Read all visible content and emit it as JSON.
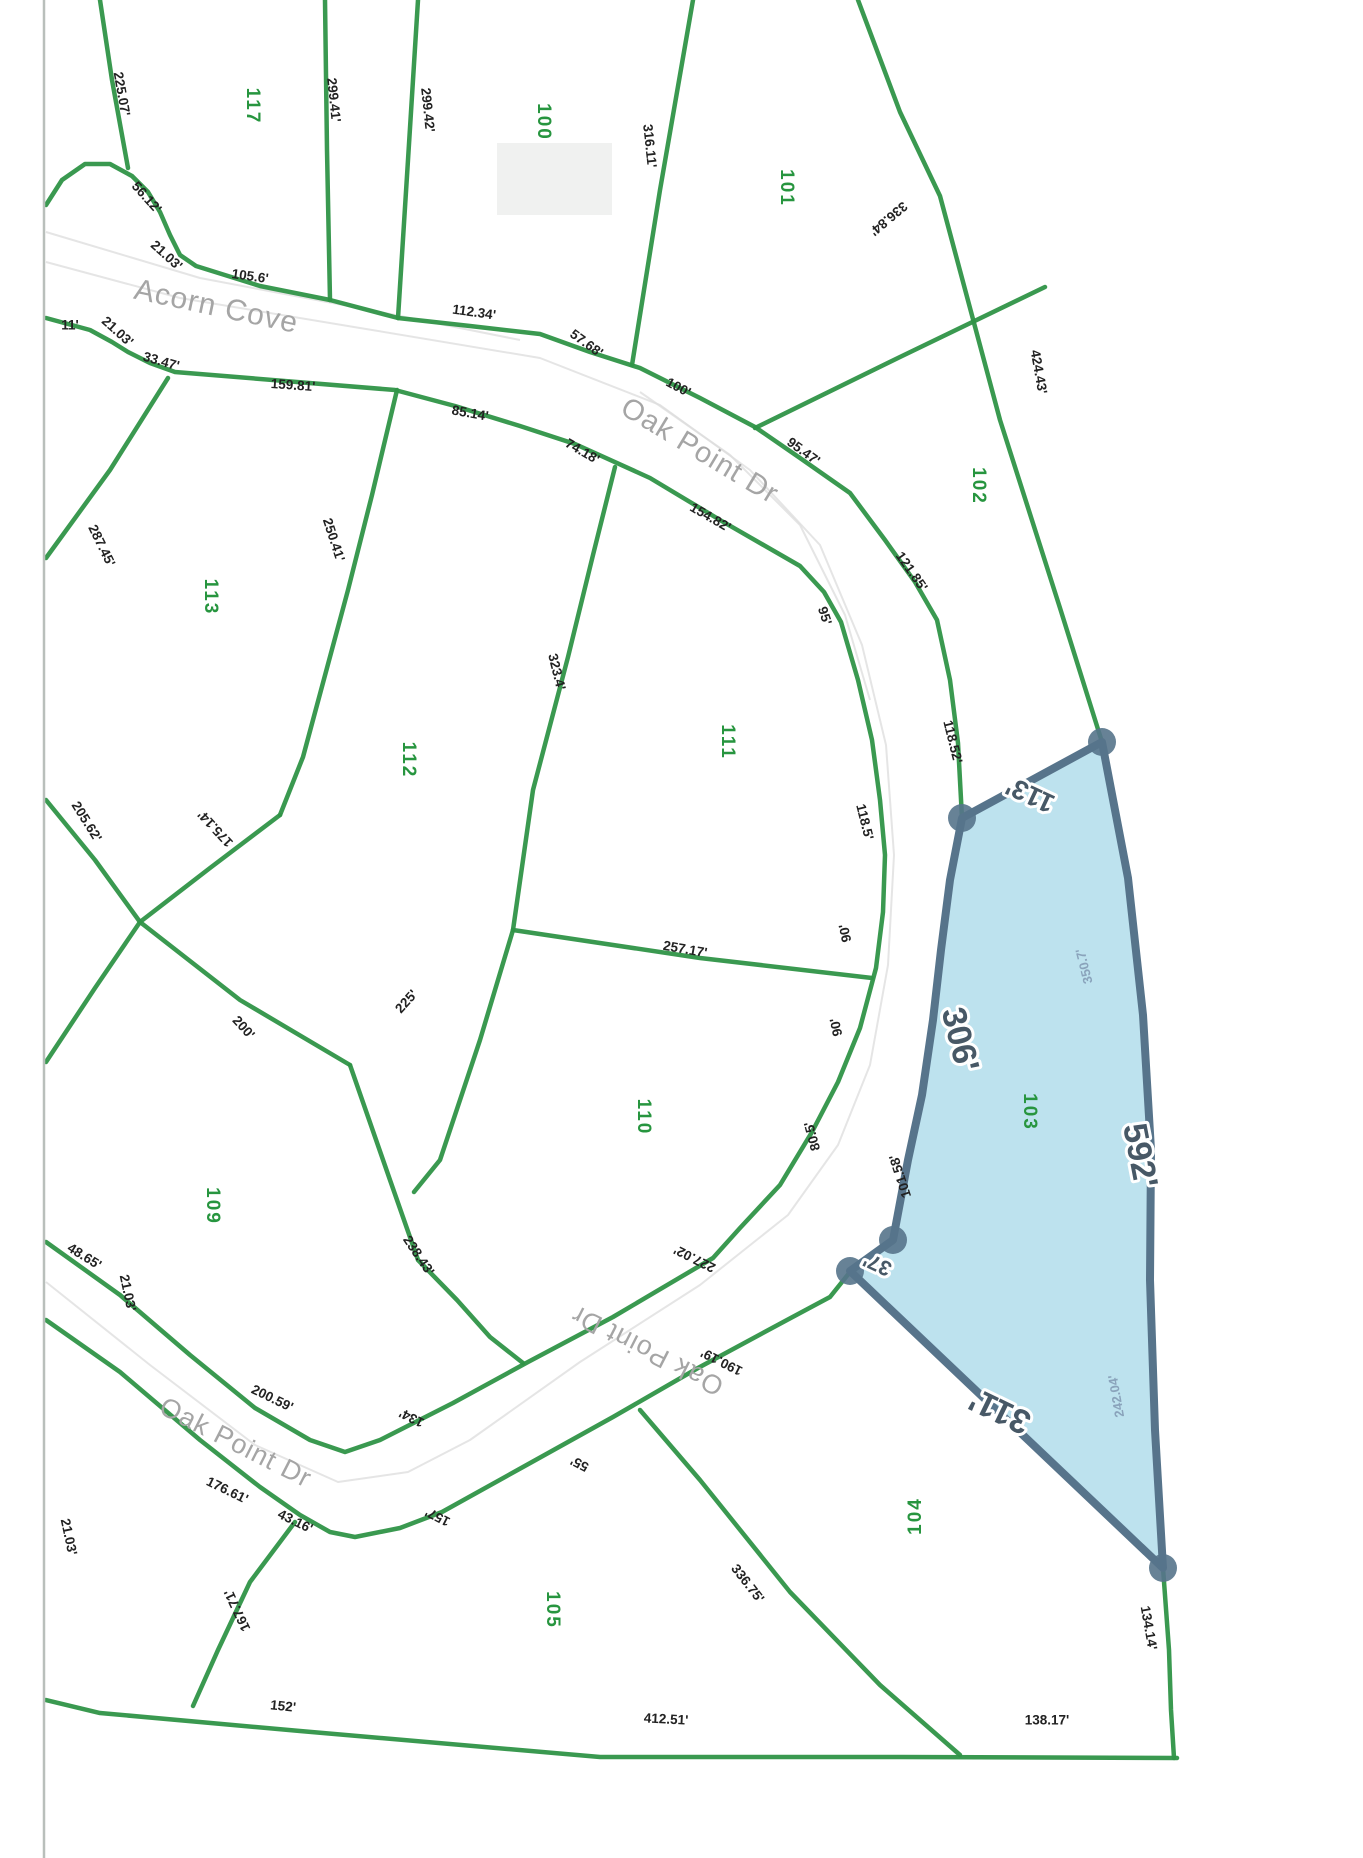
{
  "page": {
    "width": 1363,
    "height": 1858,
    "background": "#ffffff"
  },
  "colors": {
    "parcel_line": "#2f9447",
    "lot_number": "#27953f",
    "dimension_text": "#222222",
    "street_text": "#a5a5a5",
    "highlight_fill": "#b7e0ed",
    "highlight_stroke": "#57748b",
    "highlight_label": "#475866",
    "highlight_sub_label": "#8aa3bb",
    "page_edge": "#b9bfbb",
    "road_artifact": "#dcdcdc"
  },
  "streets": [
    {
      "name": "Acorn Cove",
      "x": 216,
      "y": 308,
      "rot": 12,
      "size": 30
    },
    {
      "name": "Oak Point Dr",
      "x": 699,
      "y": 452,
      "rot": 31,
      "size": 29
    },
    {
      "name": "Oak Point Dr",
      "x": 235,
      "y": 1444,
      "rot": 27,
      "size": 27
    },
    {
      "name": "Oak Point Dr",
      "x": 648,
      "y": 1349,
      "rot": 207,
      "size": 27
    }
  ],
  "lots": [
    {
      "number": "117",
      "x": 252,
      "y": 106,
      "rot": 90
    },
    {
      "number": "100",
      "x": 543,
      "y": 122,
      "rot": 90
    },
    {
      "number": "101",
      "x": 786,
      "y": 188,
      "rot": 90
    },
    {
      "number": "102",
      "x": 978,
      "y": 486,
      "rot": 90
    },
    {
      "number": "113",
      "x": 210,
      "y": 597,
      "rot": 90
    },
    {
      "number": "112",
      "x": 408,
      "y": 760,
      "rot": 90
    },
    {
      "number": "111",
      "x": 727,
      "y": 742,
      "rot": 90
    },
    {
      "number": "110",
      "x": 643,
      "y": 1117,
      "rot": 90
    },
    {
      "number": "109",
      "x": 212,
      "y": 1206,
      "rot": 90
    },
    {
      "number": "103",
      "x": 1029,
      "y": 1112,
      "rot": 90
    },
    {
      "number": "105",
      "x": 552,
      "y": 1610,
      "rot": 90
    },
    {
      "number": "104",
      "x": 916,
      "y": 1516,
      "rot": -90
    }
  ],
  "dimensions": [
    {
      "text": "225.07'",
      "x": 121,
      "y": 94,
      "rot": 80
    },
    {
      "text": "299.41'",
      "x": 333,
      "y": 100,
      "rot": 84
    },
    {
      "text": "299.42'",
      "x": 427,
      "y": 110,
      "rot": 84
    },
    {
      "text": "316.11'",
      "x": 649,
      "y": 146,
      "rot": 84
    },
    {
      "text": "336.84'",
      "x": 888,
      "y": 218,
      "rot": 140
    },
    {
      "text": "424.43'",
      "x": 1038,
      "y": 372,
      "rot": 80
    },
    {
      "text": "56.12'",
      "x": 146,
      "y": 198,
      "rot": 48
    },
    {
      "text": "21.03'",
      "x": 166,
      "y": 256,
      "rot": 42
    },
    {
      "text": "105.6'",
      "x": 250,
      "y": 277,
      "rot": 8
    },
    {
      "text": "11'",
      "x": 70,
      "y": 326,
      "rot": 0
    },
    {
      "text": "21.03'",
      "x": 117,
      "y": 332,
      "rot": 42
    },
    {
      "text": "33.47'",
      "x": 161,
      "y": 362,
      "rot": 16
    },
    {
      "text": "159.81'",
      "x": 293,
      "y": 386,
      "rot": 4
    },
    {
      "text": "112.34'",
      "x": 474,
      "y": 313,
      "rot": 8
    },
    {
      "text": "57.68'",
      "x": 586,
      "y": 344,
      "rot": 36
    },
    {
      "text": "100'",
      "x": 678,
      "y": 388,
      "rot": 28
    },
    {
      "text": "85.14'",
      "x": 470,
      "y": 414,
      "rot": 10
    },
    {
      "text": "74.18'",
      "x": 582,
      "y": 452,
      "rot": 30
    },
    {
      "text": "95.47'",
      "x": 803,
      "y": 452,
      "rot": 36
    },
    {
      "text": "154.82'",
      "x": 710,
      "y": 518,
      "rot": 30
    },
    {
      "text": "121.85'",
      "x": 911,
      "y": 572,
      "rot": 55
    },
    {
      "text": "95'",
      "x": 824,
      "y": 616,
      "rot": 72
    },
    {
      "text": "287.45'",
      "x": 101,
      "y": 546,
      "rot": 64
    },
    {
      "text": "250.41'",
      "x": 333,
      "y": 540,
      "rot": 72
    },
    {
      "text": "323.4'",
      "x": 556,
      "y": 672,
      "rot": 76
    },
    {
      "text": "205.62'",
      "x": 86,
      "y": 822,
      "rot": 58
    },
    {
      "text": "175.14'",
      "x": 216,
      "y": 828,
      "rot": 227
    },
    {
      "text": "200'",
      "x": 243,
      "y": 1028,
      "rot": 48
    },
    {
      "text": "225'",
      "x": 407,
      "y": 1002,
      "rot": -48
    },
    {
      "text": "257.17'",
      "x": 685,
      "y": 950,
      "rot": 10
    },
    {
      "text": "118.52'",
      "x": 952,
      "y": 742,
      "rot": 76
    },
    {
      "text": "118.5'",
      "x": 864,
      "y": 822,
      "rot": 76
    },
    {
      "text": "90'",
      "x": 846,
      "y": 933,
      "rot": -102
    },
    {
      "text": "90'",
      "x": 837,
      "y": 1027,
      "rot": -102
    },
    {
      "text": "80.5'",
      "x": 813,
      "y": 1136,
      "rot": -105
    },
    {
      "text": "101.58'",
      "x": 901,
      "y": 1176,
      "rot": -108
    },
    {
      "text": "48.65'",
      "x": 84,
      "y": 1257,
      "rot": 32
    },
    {
      "text": "21.03'",
      "x": 127,
      "y": 1293,
      "rot": 78
    },
    {
      "text": "238.43'",
      "x": 418,
      "y": 1256,
      "rot": 56
    },
    {
      "text": "227.02'",
      "x": 695,
      "y": 1258,
      "rot": 207
    },
    {
      "text": "190.19'",
      "x": 722,
      "y": 1361,
      "rot": 207
    },
    {
      "text": "200.59'",
      "x": 272,
      "y": 1399,
      "rot": 26
    },
    {
      "text": "134'",
      "x": 412,
      "y": 1417,
      "rot": 207
    },
    {
      "text": "176.61'",
      "x": 227,
      "y": 1491,
      "rot": 26
    },
    {
      "text": "43.16'",
      "x": 295,
      "y": 1522,
      "rot": 26
    },
    {
      "text": "157'",
      "x": 438,
      "y": 1516,
      "rot": 207
    },
    {
      "text": "55'",
      "x": 580,
      "y": 1463,
      "rot": 207
    },
    {
      "text": "21.03'",
      "x": 68,
      "y": 1537,
      "rot": 78
    },
    {
      "text": "167.71'",
      "x": 238,
      "y": 1610,
      "rot": 245
    },
    {
      "text": "152'",
      "x": 283,
      "y": 1707,
      "rot": 6
    },
    {
      "text": "336.75'",
      "x": 747,
      "y": 1584,
      "rot": 52
    },
    {
      "text": "412.51'",
      "x": 666,
      "y": 1720,
      "rot": 3
    },
    {
      "text": "138.17'",
      "x": 1047,
      "y": 1721,
      "rot": 0
    },
    {
      "text": "134.14'",
      "x": 1148,
      "y": 1628,
      "rot": 80
    }
  ],
  "highlight": {
    "lot": "103",
    "polygon": [
      [
        1102,
        742
      ],
      [
        962,
        818
      ],
      [
        950,
        880
      ],
      [
        941,
        950
      ],
      [
        933,
        1020
      ],
      [
        922,
        1095
      ],
      [
        908,
        1160
      ],
      [
        893,
        1240
      ],
      [
        850,
        1271
      ],
      [
        1163,
        1568
      ],
      [
        1155,
        1430
      ],
      [
        1150,
        1280
      ],
      [
        1151,
        1150
      ],
      [
        1143,
        1015
      ],
      [
        1128,
        878
      ]
    ],
    "vertices": [
      [
        1102,
        742
      ],
      [
        962,
        818
      ],
      [
        893,
        1240
      ],
      [
        850,
        1271
      ],
      [
        1163,
        1568
      ]
    ],
    "labels": [
      {
        "text": "113'",
        "x": 1031,
        "y": 793,
        "rot": 205,
        "size": 27
      },
      {
        "text": "306'",
        "x": 958,
        "y": 1040,
        "rot": 76,
        "size": 34
      },
      {
        "text": "592'",
        "x": 1138,
        "y": 1156,
        "rot": 79,
        "size": 34
      },
      {
        "text": "311'",
        "x": 1001,
        "y": 1409,
        "rot": 206,
        "size": 34
      },
      {
        "text": "37'",
        "x": 878,
        "y": 1263,
        "rot": 205,
        "size": 21
      }
    ],
    "sub_labels": [
      {
        "text": "350.7'",
        "x": 1085,
        "y": 966,
        "rot": 256
      },
      {
        "text": "242.04'",
        "x": 1117,
        "y": 1396,
        "rot": 260
      }
    ]
  },
  "green_lines": [
    [
      [
        100,
        0
      ],
      [
        112,
        80
      ],
      [
        128,
        168
      ]
    ],
    [
      [
        46,
        205
      ],
      [
        62,
        180
      ],
      [
        85,
        164
      ],
      [
        110,
        164
      ],
      [
        132,
        176
      ],
      [
        148,
        192
      ],
      [
        160,
        212
      ],
      [
        170,
        235
      ],
      [
        180,
        255
      ],
      [
        196,
        266
      ],
      [
        260,
        286
      ],
      [
        330,
        300
      ]
    ],
    [
      [
        325,
        0
      ],
      [
        327,
        150
      ],
      [
        330,
        300
      ]
    ],
    [
      [
        418,
        0
      ],
      [
        408,
        160
      ],
      [
        398,
        318
      ]
    ],
    [
      [
        330,
        300
      ],
      [
        398,
        318
      ]
    ],
    [
      [
        398,
        318
      ],
      [
        470,
        326
      ],
      [
        540,
        334
      ],
      [
        590,
        352
      ],
      [
        640,
        368
      ],
      [
        700,
        398
      ],
      [
        755,
        427
      ],
      [
        800,
        458
      ],
      [
        850,
        493
      ],
      [
        885,
        540
      ],
      [
        915,
        582
      ],
      [
        937,
        620
      ],
      [
        950,
        680
      ],
      [
        958,
        743
      ],
      [
        962,
        818
      ]
    ],
    [
      [
        46,
        318
      ],
      [
        90,
        330
      ],
      [
        112,
        342
      ],
      [
        128,
        352
      ],
      [
        150,
        363
      ],
      [
        175,
        372
      ],
      [
        395,
        390
      ],
      [
        455,
        406
      ],
      [
        520,
        426
      ],
      [
        575,
        444
      ],
      [
        650,
        478
      ],
      [
        720,
        520
      ],
      [
        800,
        566
      ],
      [
        824,
        592
      ],
      [
        841,
        622
      ],
      [
        858,
        680
      ],
      [
        872,
        740
      ],
      [
        880,
        800
      ],
      [
        885,
        855
      ],
      [
        883,
        912
      ],
      [
        876,
        968
      ],
      [
        860,
        1028
      ],
      [
        838,
        1082
      ],
      [
        812,
        1132
      ],
      [
        780,
        1185
      ],
      [
        740,
        1228
      ],
      [
        713,
        1258
      ],
      [
        613,
        1317
      ],
      [
        528,
        1362
      ],
      [
        453,
        1403
      ],
      [
        380,
        1440
      ],
      [
        345,
        1452
      ],
      [
        310,
        1440
      ],
      [
        255,
        1408
      ],
      [
        190,
        1355
      ],
      [
        120,
        1295
      ],
      [
        46,
        1242
      ]
    ],
    [
      [
        46,
        1320
      ],
      [
        120,
        1372
      ],
      [
        200,
        1440
      ],
      [
        260,
        1487
      ],
      [
        300,
        1515
      ],
      [
        330,
        1532
      ],
      [
        355,
        1537
      ],
      [
        400,
        1528
      ],
      [
        442,
        1512
      ],
      [
        523,
        1467
      ],
      [
        613,
        1417
      ],
      [
        698,
        1368
      ],
      [
        787,
        1320
      ],
      [
        830,
        1297
      ],
      [
        850,
        1272
      ]
    ],
    [
      [
        693,
        0
      ],
      [
        660,
        190
      ],
      [
        632,
        365
      ]
    ],
    [
      [
        858,
        0
      ],
      [
        900,
        112
      ],
      [
        940,
        196
      ],
      [
        1000,
        420
      ],
      [
        1060,
        608
      ],
      [
        1102,
        742
      ]
    ],
    [
      [
        755,
        428
      ],
      [
        900,
        357
      ],
      [
        1045,
        287
      ]
    ],
    [
      [
        168,
        378
      ],
      [
        110,
        470
      ],
      [
        46,
        558
      ]
    ],
    [
      [
        397,
        390
      ],
      [
        372,
        495
      ],
      [
        348,
        590
      ],
      [
        303,
        757
      ],
      [
        280,
        815
      ]
    ],
    [
      [
        280,
        815
      ],
      [
        210,
        868
      ],
      [
        140,
        922
      ],
      [
        95,
        988
      ],
      [
        46,
        1062
      ]
    ],
    [
      [
        46,
        800
      ],
      [
        95,
        860
      ],
      [
        140,
        922
      ],
      [
        240,
        1000
      ],
      [
        350,
        1065
      ]
    ],
    [
      [
        350,
        1065
      ],
      [
        390,
        1180
      ],
      [
        418,
        1260
      ],
      [
        457,
        1300
      ],
      [
        490,
        1337
      ],
      [
        523,
        1363
      ]
    ],
    [
      [
        513,
        930
      ],
      [
        480,
        1040
      ],
      [
        440,
        1160
      ],
      [
        414,
        1192
      ]
    ],
    [
      [
        615,
        467
      ],
      [
        593,
        555
      ],
      [
        568,
        657
      ],
      [
        533,
        790
      ],
      [
        513,
        930
      ]
    ],
    [
      [
        513,
        930
      ],
      [
        700,
        958
      ],
      [
        872,
        978
      ]
    ],
    [
      [
        295,
        1522
      ],
      [
        250,
        1582
      ],
      [
        218,
        1650
      ],
      [
        193,
        1706
      ]
    ],
    [
      [
        640,
        1410
      ],
      [
        700,
        1480
      ],
      [
        790,
        1592
      ],
      [
        880,
        1685
      ],
      [
        960,
        1755
      ]
    ],
    [
      [
        1163,
        1568
      ],
      [
        1169,
        1650
      ],
      [
        1171,
        1710
      ],
      [
        1174,
        1758
      ]
    ],
    [
      [
        46,
        1700
      ],
      [
        100,
        1713
      ],
      [
        300,
        1731
      ],
      [
        600,
        1757
      ],
      [
        900,
        1757
      ],
      [
        1177,
        1758
      ]
    ]
  ],
  "gray_lines": [
    [
      [
        46,
        262
      ],
      [
        180,
        298
      ],
      [
        360,
        328
      ],
      [
        540,
        358
      ],
      [
        660,
        405
      ],
      [
        750,
        470
      ],
      [
        820,
        545
      ],
      [
        862,
        645
      ],
      [
        886,
        745
      ],
      [
        894,
        855
      ],
      [
        888,
        965
      ],
      [
        870,
        1065
      ],
      [
        838,
        1145
      ],
      [
        788,
        1215
      ],
      [
        700,
        1285
      ],
      [
        580,
        1362
      ],
      [
        470,
        1440
      ],
      [
        408,
        1472
      ],
      [
        338,
        1482
      ],
      [
        255,
        1445
      ],
      [
        150,
        1365
      ],
      [
        46,
        1282
      ]
    ],
    [
      [
        46,
        232
      ],
      [
        200,
        278
      ],
      [
        380,
        312
      ],
      [
        520,
        340
      ]
    ],
    [
      [
        640,
        392
      ],
      [
        730,
        455
      ],
      [
        800,
        525
      ],
      [
        845,
        615
      ],
      [
        870,
        700
      ]
    ]
  ],
  "building_artifact": {
    "x": 497,
    "y": 143,
    "w": 115,
    "h": 72
  },
  "page_edge": {
    "x": 44,
    "y1": 0,
    "y2": 1858
  }
}
